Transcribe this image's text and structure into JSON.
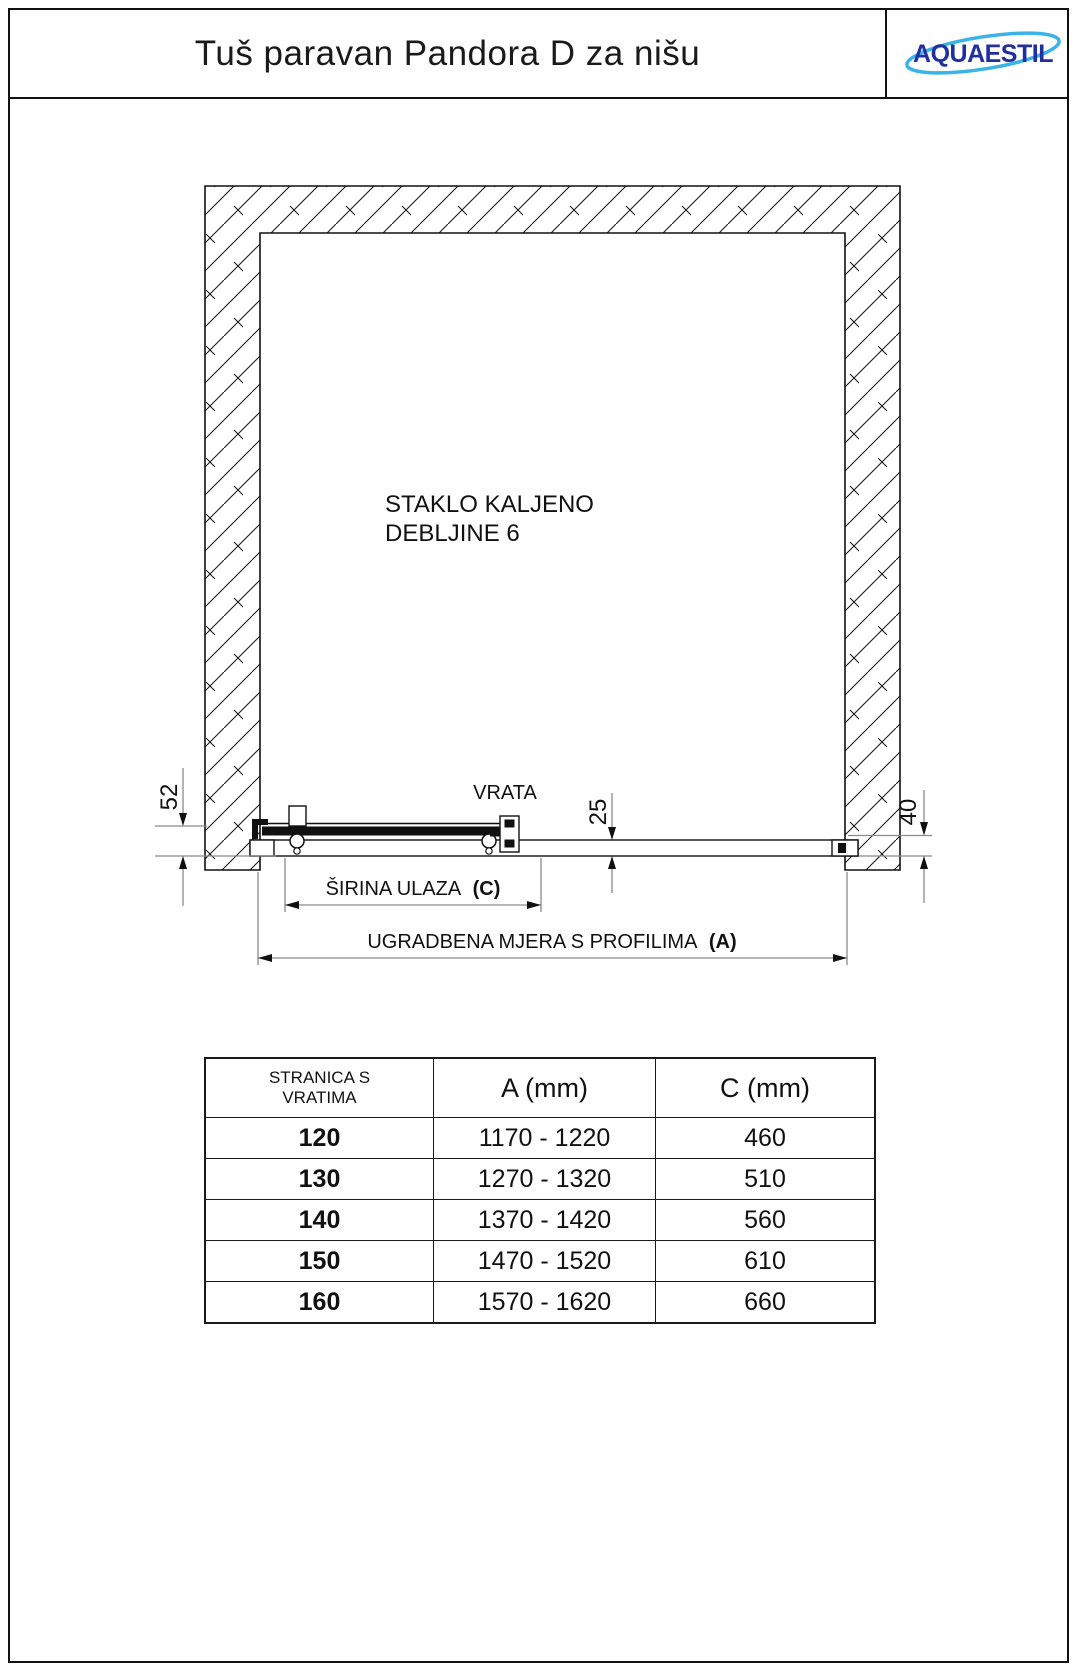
{
  "header": {
    "title": "Tuš paravan Pandora D za nišu",
    "logo_text": "AQUAESTIL"
  },
  "colors": {
    "logo_blue": "#22309f",
    "logo_swoosh": "#3ab3e8"
  },
  "drawing": {
    "glass_note_line1": "STAKLO KALJENO",
    "glass_note_line2": "DEBLJINE 6",
    "door_label": "VRATA",
    "dim_left": "52",
    "dim_panel": "25",
    "dim_wall": "40",
    "dim_c_label": "ŠIRINA ULAZA",
    "dim_c_suffix": "(C)",
    "dim_a_label": "UGRADBENA MJERA S PROFILIMA",
    "dim_a_suffix": "(A)"
  },
  "table": {
    "headers": {
      "col1_line1": "STRANICA S",
      "col1_line2": "VRATIMA",
      "col2": "A (mm)",
      "col3": "C (mm)"
    },
    "rows": [
      {
        "size": "120",
        "a_range": "1170 - 1220",
        "c": "460"
      },
      {
        "size": "130",
        "a_range": "1270 - 1320",
        "c": "510"
      },
      {
        "size": "140",
        "a_range": "1370 - 1420",
        "c": "560"
      },
      {
        "size": "150",
        "a_range": "1470 - 1520",
        "c": "610"
      },
      {
        "size": "160",
        "a_range": "1570 - 1620",
        "c": "660"
      }
    ]
  }
}
